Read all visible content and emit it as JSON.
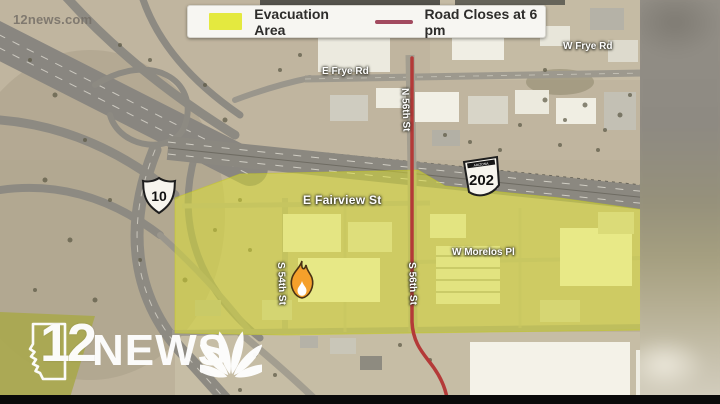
{
  "video": {
    "watermark": "12news.com",
    "letterbox_color": "#0a0a0a"
  },
  "legend": {
    "evacuation": {
      "label": "Evacuation Area",
      "swatch_color": "#e4e93f"
    },
    "road_closure": {
      "label": "Road Closes at 6 pm",
      "line_color": "#a24a5f"
    }
  },
  "map": {
    "type": "satellite",
    "streets": {
      "e_frye_rd": "E Frye Rd",
      "w_frye_rd": "W Frye Rd",
      "n_56th_st": "N 56th St",
      "s_56th_st": "S 56th St",
      "s_54th_st": "S 54th St",
      "e_fairview_st": "E Fairview St",
      "w_morelos_pl": "W Morelos Pl"
    },
    "highway_shields": {
      "interstate_10": "10",
      "loop_202": "202",
      "loop_202_state": "ARIZONA"
    },
    "overlays": {
      "evacuation_area_color": "#dfe32b",
      "road_closure_line_color": "#b43a38",
      "fire_icon_color": "#f5a02b"
    }
  },
  "branding": {
    "station_number": "12",
    "station_name": "NEWS",
    "logo_color": "#ffffff"
  }
}
